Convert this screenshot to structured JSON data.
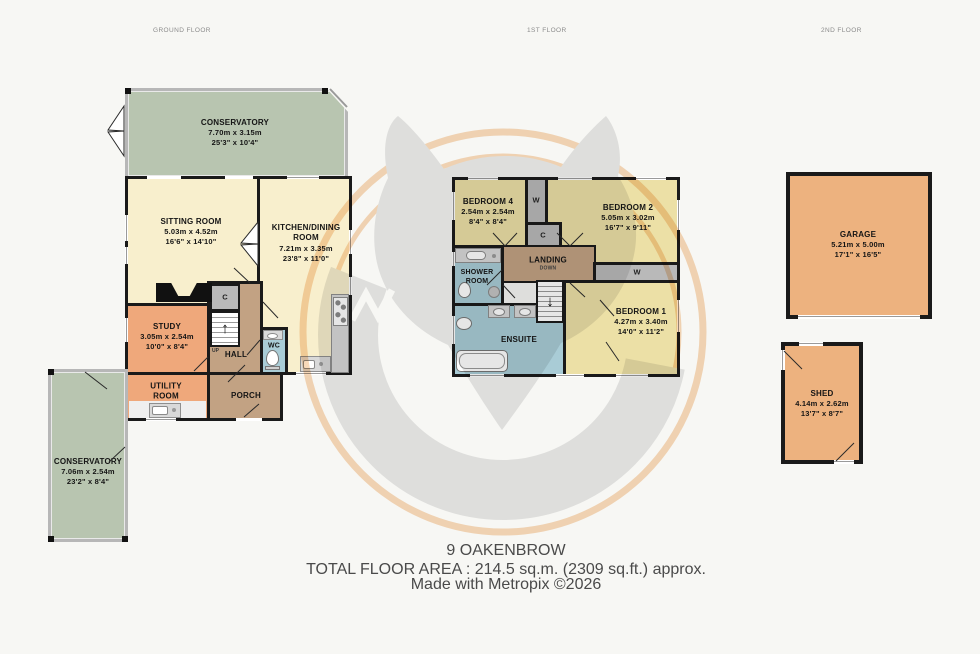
{
  "floors": {
    "ground": {
      "header": "GROUND FLOOR"
    },
    "first": {
      "header": "1ST FLOOR"
    },
    "second": {
      "header": "2ND FLOOR"
    }
  },
  "rooms": {
    "conservatory_top": {
      "name": "CONSERVATORY",
      "metric": "7.70m  x 3.15m",
      "imperial": "25'3\"  x 10'4\""
    },
    "sitting_room": {
      "name": "SITTING ROOM",
      "metric": "5.03m  x 4.52m",
      "imperial": "16'6\"  x 14'10\""
    },
    "kitchen_dining": {
      "name": "KITCHEN/DINING ROOM",
      "metric": "7.21m  x 3.35m",
      "imperial": "23'8\"  x 11'0\""
    },
    "study": {
      "name": "STUDY",
      "metric": "3.05m  x 2.54m",
      "imperial": "10'0\"  x 8'4\""
    },
    "hall": {
      "name": "HALL"
    },
    "wc": {
      "name": "WC"
    },
    "porch": {
      "name": "PORCH"
    },
    "utility": {
      "name": "UTILITY ROOM"
    },
    "conservatory_bottom": {
      "name": "CONSERVATORY",
      "metric": "7.06m  x 2.54m",
      "imperial": "23'2\"  x 8'4\""
    },
    "bedroom4": {
      "name": "BEDROOM 4",
      "metric": "2.54m  x 2.54m",
      "imperial": "8'4\"  x 8'4\""
    },
    "bedroom2": {
      "name": "BEDROOM 2",
      "metric": "5.05m  x 3.02m",
      "imperial": "16'7\"  x 9'11\""
    },
    "shower_room": {
      "name": "SHOWER ROOM"
    },
    "landing": {
      "name": "LANDING",
      "down": "DOWN"
    },
    "bedroom1": {
      "name": "BEDROOM 1",
      "metric": "4.27m  x 3.40m",
      "imperial": "14'0\"  x 11'2\""
    },
    "ensuite": {
      "name": "ENSUITE"
    },
    "garage": {
      "name": "GARAGE",
      "metric": "5.21m  x 5.00m",
      "imperial": "17'1\"  x 16'5\""
    },
    "shed": {
      "name": "SHED",
      "metric": "4.14m  x 2.62m",
      "imperial": "13'7\"  x 8'7\""
    }
  },
  "closets": {
    "wardrobe": "W",
    "cupboard": "C"
  },
  "stairs": {
    "up": "UP"
  },
  "icons": {
    "up_arrow": "↑",
    "down_arrow": "↓"
  },
  "footer": {
    "property_name": "9 OAKENBROW",
    "total_area": "TOTAL FLOOR AREA : 214.5 sq.m. (2309 sq.ft.) approx.",
    "credit": "Made with Metropix ©2026"
  },
  "palette": {
    "background": "#f7f7f4",
    "wall_black": "#1a1a1a",
    "cream_room": "#f8efcd",
    "orange_room": "#efa87b",
    "tan_room": "#c2a283",
    "blue_room": "#a9ccd6",
    "green_room": "#b8c5b0",
    "yellow_room": "#ece0a6",
    "garage_orange": "#edb27f",
    "closet_gray": "#b9b9b9",
    "counter_gray": "#d9d9d9",
    "watermark_gray": "#d2d2d2",
    "watermark_orange": "#f0b87f"
  }
}
